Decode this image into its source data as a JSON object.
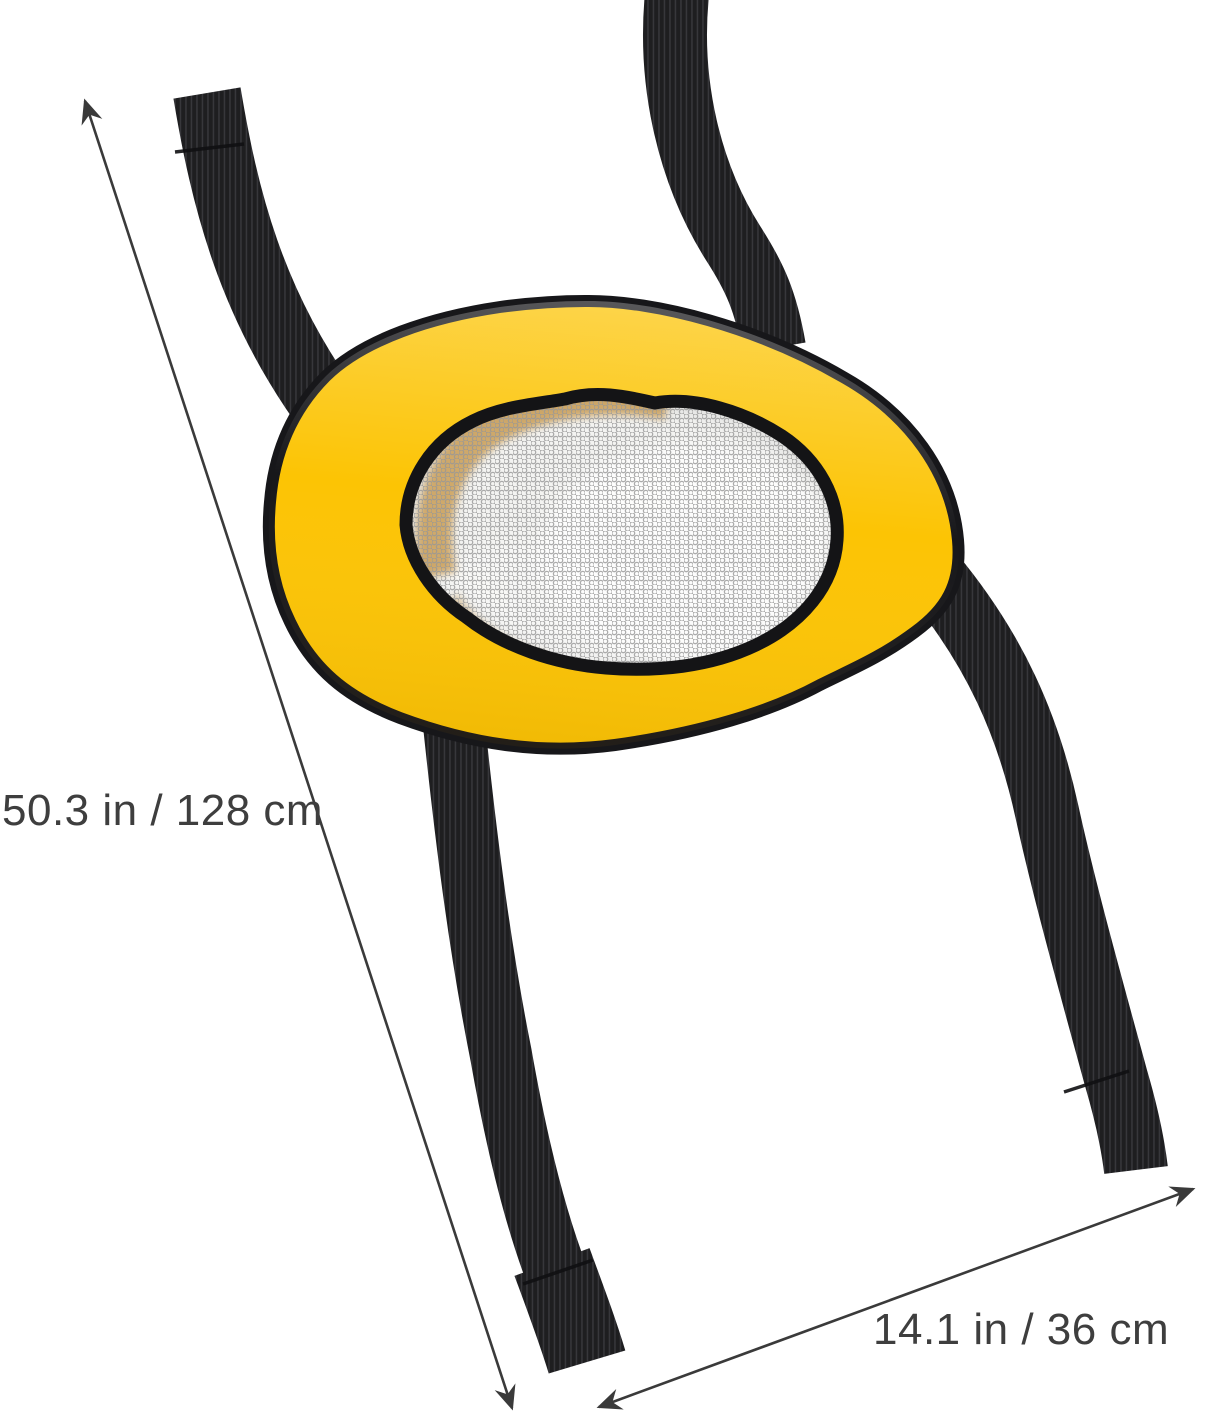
{
  "annotations": {
    "length_label": "50.3 in / 128 cm",
    "width_label": "14.1 in / 36 cm",
    "text_color": "#3E3E3E",
    "line_color": "#3A3A3A"
  },
  "product": {
    "colors": {
      "body": "#FCC404",
      "trim": "#17171A",
      "strap": "#1E1E20",
      "strap_rib": "#37373B",
      "mesh_base": "#F3F3F1",
      "mesh_dot": "#979797",
      "show_through": "#C6964A"
    }
  }
}
